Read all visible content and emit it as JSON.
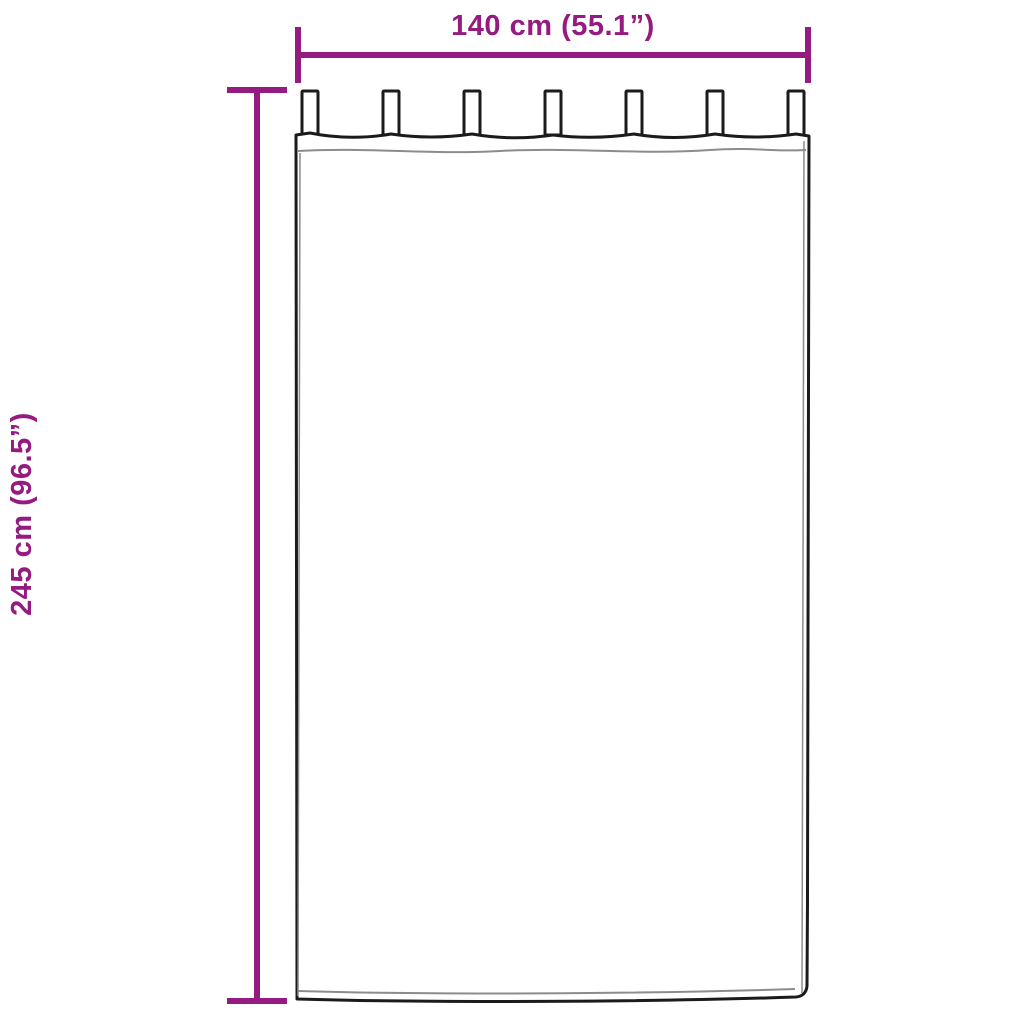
{
  "diagram": {
    "width_label": "140 cm (55.1”)",
    "height_label": "245 cm (96.5”)",
    "tab_count": 7
  },
  "colors": {
    "dimension": "#951B81",
    "outline": "#1b1b1b",
    "hem": "#8c8c8c",
    "background": "#ffffff"
  }
}
